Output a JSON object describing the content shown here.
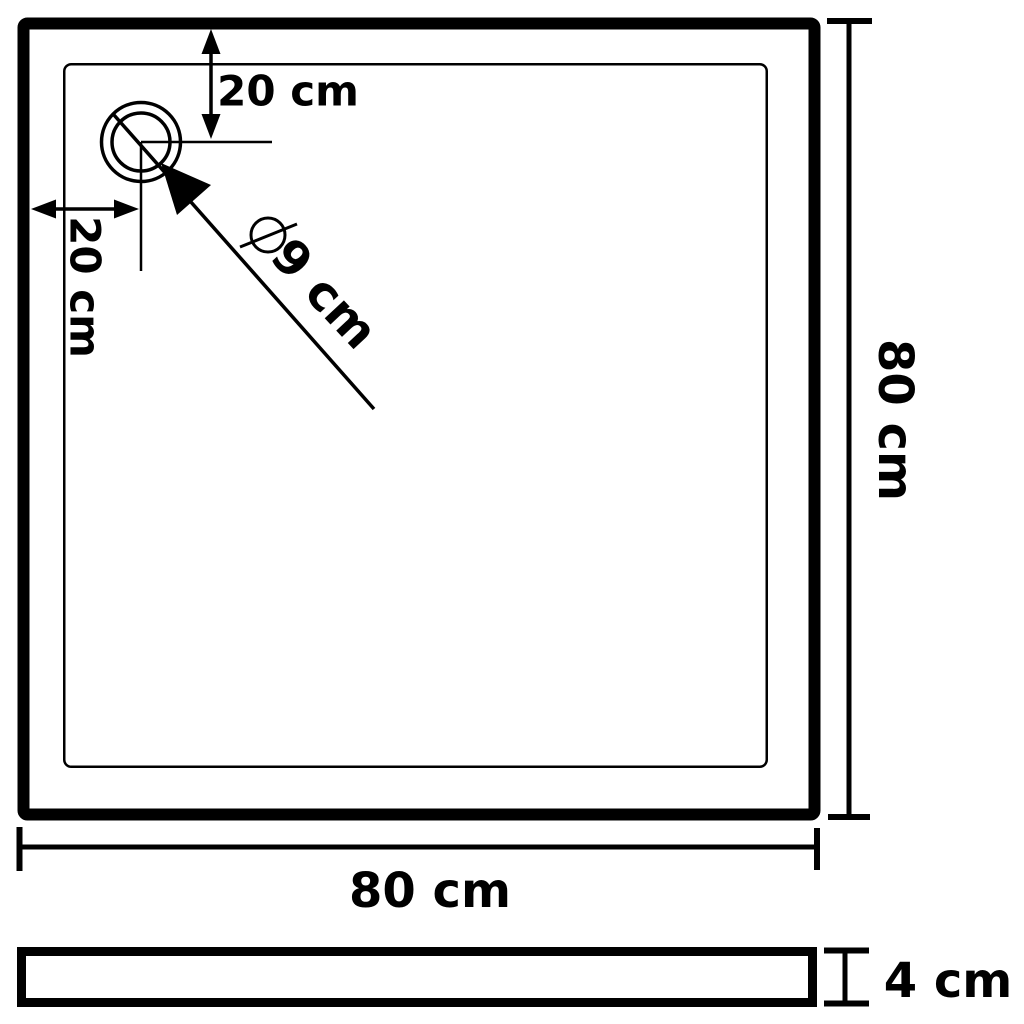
{
  "colors": {
    "background": "#ffffff",
    "line": "#000000"
  },
  "top_view": {
    "width_label": "80 cm",
    "height_label": "80 cm",
    "drain": {
      "offset_top": "20 cm",
      "offset_left": "20 cm",
      "diameter_symbol": "⌀",
      "diameter": "9 cm"
    }
  },
  "side_view": {
    "thickness": "4 cm"
  }
}
